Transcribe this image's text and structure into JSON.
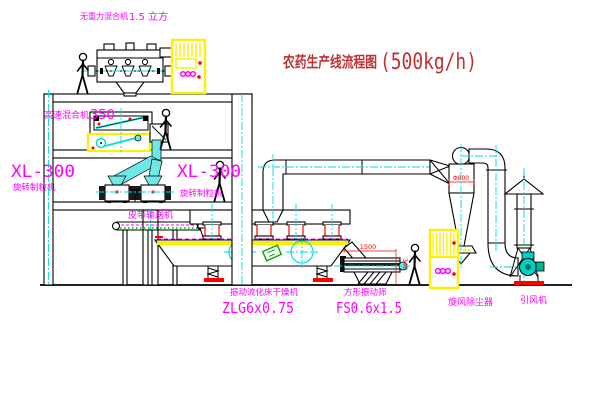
{
  "title": {
    "text": "农药生产线流程图",
    "capacity": "(500kg/h)"
  },
  "equipment": {
    "gravity_mixer": {
      "name": "无重力混合机",
      "spec": "1.5 立方"
    },
    "high_speed_mixer": {
      "name": "高速混合机",
      "spec": "350"
    },
    "granulator_left": {
      "model": "XL-300",
      "name": "旋转制粒机"
    },
    "granulator_right": {
      "model": "XL-300",
      "name": "旋转制粒机"
    },
    "belt_conveyor": {
      "name": "皮带输送机"
    },
    "fluid_bed_dryer": {
      "name": "振动流化床干燥机",
      "model": "ZLG6x0.75"
    },
    "vibrating_screen": {
      "name": "方形振动筛",
      "model": "FS0.6x1.5"
    },
    "cyclone": {
      "name": "旋风除尘器"
    },
    "fan": {
      "name": "引风机"
    }
  },
  "dimensions": {
    "cyclone_diameter": "Φ800",
    "screen_length": "1500",
    "screen_height": "340"
  },
  "colors": {
    "label_magenta": "#ff00ff",
    "title_red": "#c03030",
    "accent_red": "#ff0000",
    "centerline_cyan": "#00dede",
    "pipe_fill_cyan": "#70e8e8",
    "cabinet_yellow": "#ffef00",
    "plate_green": "#00aa00",
    "line_black": "#000000"
  }
}
